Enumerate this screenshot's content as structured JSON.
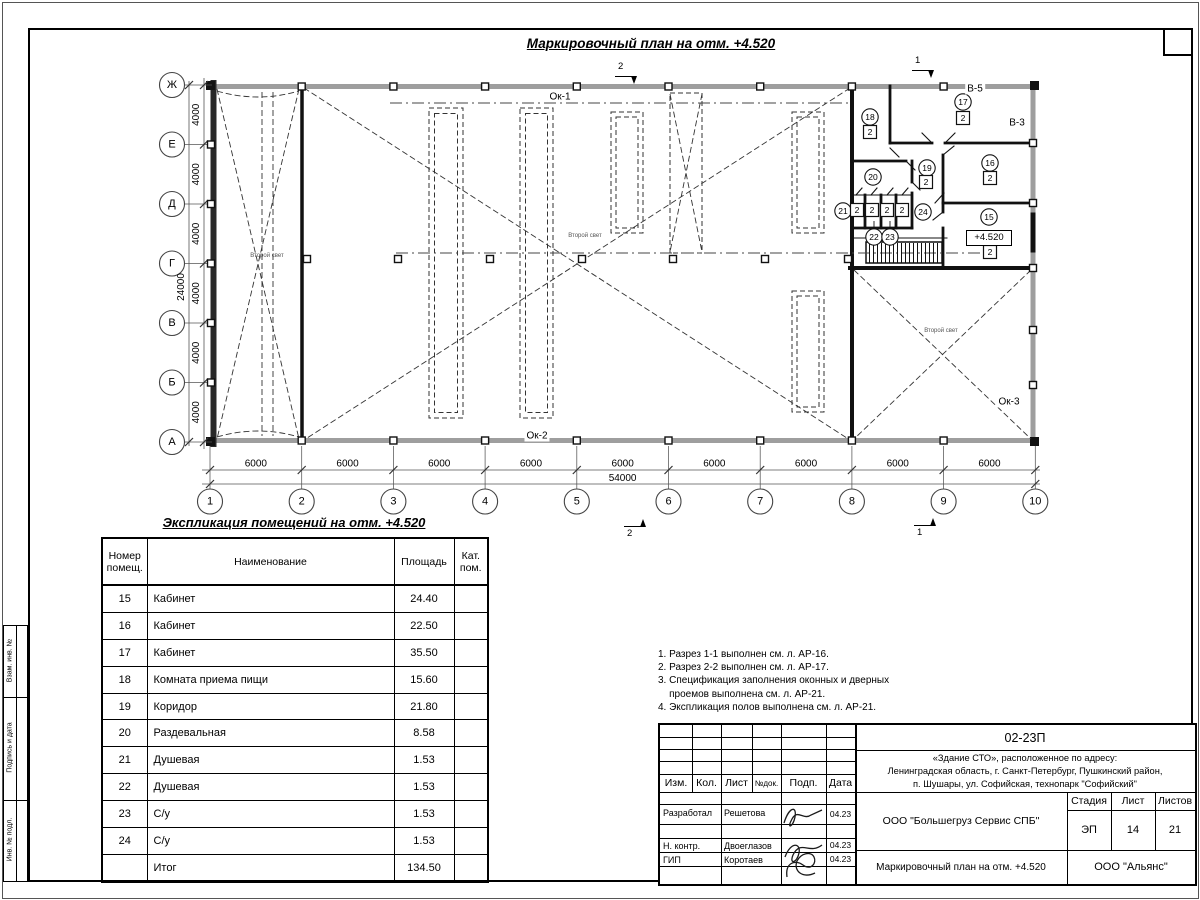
{
  "plan": {
    "title": "Маркировочный план на отм. +4.520",
    "axes_rows": [
      "Ж",
      "Е",
      "Д",
      "Г",
      "В",
      "Б",
      "А"
    ],
    "axes_cols": [
      "1",
      "2",
      "3",
      "4",
      "5",
      "6",
      "7",
      "8",
      "9",
      "10"
    ],
    "dim_row_segment": "4000",
    "dim_row_total": "24000",
    "dim_col_segment": "6000",
    "dim_col_total": "54000",
    "windows": {
      "ok1": "Ок-1",
      "ok2": "Ок-2",
      "ok3": "Ок-3"
    },
    "vents": {
      "v5": "В-5",
      "v3": "В-3"
    },
    "second_light": "Второй свет",
    "elevation": "+4.520",
    "sections": {
      "s1": "1",
      "s2": "2"
    },
    "room_marks": [
      {
        "num": "15",
        "cat": "2"
      },
      {
        "num": "16",
        "cat": "2"
      },
      {
        "num": "17",
        "cat": "2"
      },
      {
        "num": "18",
        "cat": "2"
      },
      {
        "num": "19",
        "cat": "2"
      },
      {
        "num": "20",
        "cat": ""
      },
      {
        "num": "21",
        "cat": "2"
      },
      {
        "num": "22",
        "cat": "2"
      },
      {
        "num": "23",
        "cat": "2"
      },
      {
        "num": "24",
        "cat": "2"
      }
    ]
  },
  "schedule": {
    "title": "Экспликация помещений на отм. +4.520",
    "headers": [
      "Номер помещ.",
      "Наименование",
      "Площадь",
      "Кат. пом."
    ],
    "rows": [
      [
        "15",
        "Кабинет",
        "24.40",
        ""
      ],
      [
        "16",
        "Кабинет",
        "22.50",
        ""
      ],
      [
        "17",
        "Кабинет",
        "35.50",
        ""
      ],
      [
        "18",
        "Комната приема пищи",
        "15.60",
        ""
      ],
      [
        "19",
        "Коридор",
        "21.80",
        ""
      ],
      [
        "20",
        "Раздевальная",
        "8.58",
        ""
      ],
      [
        "21",
        "Душевая",
        "1.53",
        ""
      ],
      [
        "22",
        "Душевая",
        "1.53",
        ""
      ],
      [
        "23",
        "С/у",
        "1.53",
        ""
      ],
      [
        "24",
        "С/у",
        "1.53",
        ""
      ],
      [
        "",
        "Итог",
        "134.50",
        ""
      ]
    ]
  },
  "notes": {
    "lines": [
      "1. Разрез 1-1 выполнен см. л. АР-16.",
      "2. Разрез 2-2 выполнен см. л. АР-17.",
      "3. Спецификация заполнения оконных и дверных",
      "    проемов выполнена см. л. АР-21.",
      "4. Экспликация полов выполнена см. л. АР-21."
    ]
  },
  "titleblock": {
    "doc_number": "02-23П",
    "address_lines": [
      "«Здание СТО», расположенное по адресу:",
      "Ленинградская область, г. Санкт-Петербург, Пушкинский район,",
      "п. Шушары, ул. Софийская, технопарк \"Софийский\""
    ],
    "header_cols": [
      "Изм.",
      "Кол.",
      "Лист",
      "№док.",
      "Подп.",
      "Дата"
    ],
    "roles": [
      {
        "role": "Разработал",
        "name": "Решетова",
        "date": "04.23"
      },
      {
        "role": "Н. контр.",
        "name": "Двоеглазов",
        "date": "04.23"
      },
      {
        "role": "ГИП",
        "name": "Коротаев",
        "date": "04.23"
      }
    ],
    "company": "ООО \"Большегруз Сервис СПБ\"",
    "stage_label": "Стадия",
    "sheet_label": "Лист",
    "sheets_label": "Листов",
    "stage": "ЭП",
    "sheet": "14",
    "sheets": "21",
    "plan_name": "Маркировочный план на отм. +4.520",
    "org": "ООО \"Альянс\""
  },
  "sheet": {
    "margin_labels": [
      "Взам. инв. №",
      "Подпись и дата",
      "Инв. № подл."
    ]
  }
}
